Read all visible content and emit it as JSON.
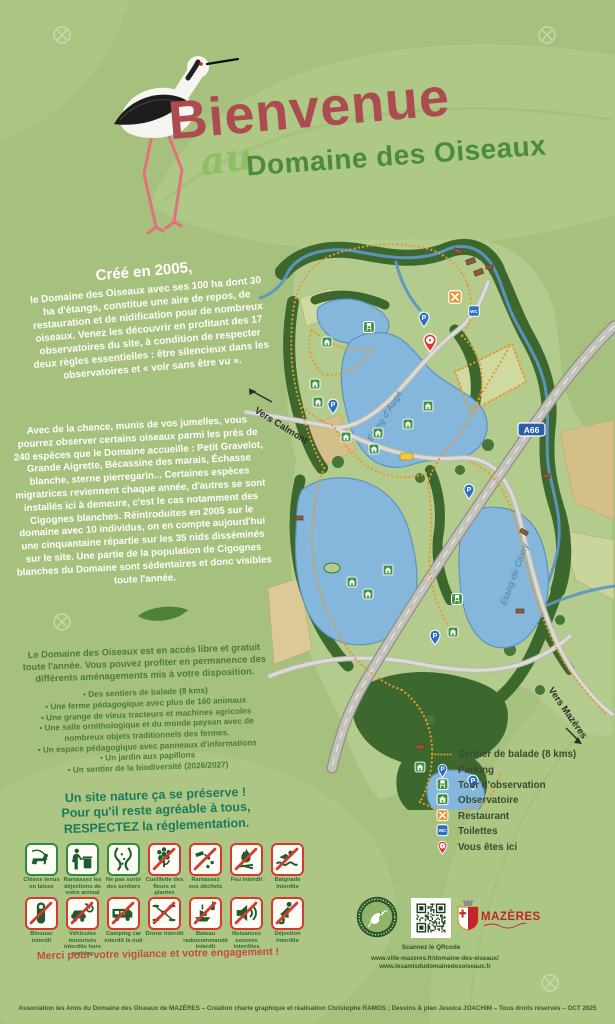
{
  "poster": {
    "title_main": "Bienvenue",
    "title_prefix": "au",
    "title_sub": "Domaine des Oiseaux"
  },
  "intro": {
    "heading": "Créé en 2005,",
    "body": "le Domaine des Oiseaux avec ses 100 ha dont 30 ha d'étangs, constitue une aire de repos, de restauration et de nidification pour de nombreux oiseaux. Venez les découvrir en profitant des 17 observatoires du site, à condition de respecter deux règles essentielles : être silencieux dans les observatoires et « voir sans être vu »."
  },
  "species_paragraph": "Avec de la chance, munis de vos jumelles, vous pourrez observer certains oiseaux parmi les près de 240 espèces que le Domaine accueille : Petit Gravelot, Grande Aigrette, Bécassine des marais, Échasse blanche, sterne pierregarin... Certaines espèces migratrices reviennent chaque année, d'autres se sont installés ici à demeure, c'est le cas notamment des Cigognes blanches. Réintroduites en 2005 sur le domaine avec 10 individus, on en compte aujourd'hui une cinquantaine répartie sur les 35 nids disséminés sur le site. Une partie de la population de Cigognes blanches du Domaine sont sédentaires et donc visibles toute l'année.",
  "access": {
    "intro": "Le Domaine des Oiseaux est en accès libre et gratuit toute l'année. Vous pouvez profiter en permanence des différents aménagements mis à votre disposition.",
    "items": [
      "Des sentiers de balade (8 kms)",
      "Une ferme pédagogique avec plus de 160 animaux",
      "Une grange de vieux tracteurs et machines agricoles",
      "Une salle ornithologique et du monde paysan avec de nombreux objets traditionnels des fermes.",
      "Un espace pédagogique avec panneaux d'informations",
      "Un jardin aux papillons",
      "Un sentier de la biodiversité (2026/2027)"
    ]
  },
  "rules": {
    "heading_line1": "Un site nature ça se préserve !",
    "heading_line2": "Pour qu'il reste agréable à tous,",
    "heading_line3": "RESPECTEZ la réglementation.",
    "row1": [
      {
        "icon": "dog-leash-icon",
        "type": "allowed",
        "label": "Chiens tenus en laisse"
      },
      {
        "icon": "pet-waste-icon",
        "type": "allowed",
        "label": "Ramassez les déjections de votre animal"
      },
      {
        "icon": "stay-on-path-icon",
        "type": "allowed",
        "label": "Ne pas sortir des sentiers"
      },
      {
        "icon": "flower-picking-icon",
        "type": "forbidden",
        "label": "Cueillette des fleurs et plantes interdite"
      },
      {
        "icon": "litter-icon",
        "type": "forbidden",
        "label": "Ramassez vos déchets"
      },
      {
        "icon": "fire-icon",
        "type": "forbidden",
        "label": "Feu interdit"
      },
      {
        "icon": "swimming-icon",
        "type": "forbidden",
        "label": "Baignade interdite"
      }
    ],
    "row2": [
      {
        "icon": "bivouac-icon",
        "type": "forbidden",
        "label": "Bivouac interdit"
      },
      {
        "icon": "motor-vehicle-icon",
        "type": "forbidden",
        "label": "Véhicules motorisés interdits hors parking"
      },
      {
        "icon": "camper-icon",
        "type": "forbidden",
        "label": "Camping car interdit la nuit"
      },
      {
        "icon": "drone-icon",
        "type": "forbidden",
        "label": "Drone interdit"
      },
      {
        "icon": "rc-boat-icon",
        "type": "forbidden",
        "label": "Bateau radiocommandé interdit"
      },
      {
        "icon": "noise-icon",
        "type": "forbidden",
        "label": "Nuisances sonores interdites"
      },
      {
        "icon": "defecation-icon",
        "type": "forbidden",
        "label": "Déjection interdite"
      }
    ],
    "thanks": "Merci pour votre vigilance et votre engagement !"
  },
  "map": {
    "labels": {
      "to_calmont": "Vers Calmont",
      "to_mazeres": "Vers Mazères",
      "highway": "A66",
      "lake_auge": "Étang d'Augé",
      "lake_cluny": "Étang de Cluny"
    },
    "legend": [
      {
        "icon": "trail-line-icon",
        "label": "Sentier de balade (8 kms)"
      },
      {
        "icon": "parking-pin-icon",
        "label": "Parking"
      },
      {
        "icon": "observation-tower-icon",
        "label": "Tour d'observation"
      },
      {
        "icon": "observatory-icon",
        "label": "Observatoire"
      },
      {
        "icon": "restaurant-icon",
        "label": "Restaurant"
      },
      {
        "icon": "toilets-icon",
        "label": "Toilettes"
      },
      {
        "icon": "you-are-here-icon",
        "label": "Vous êtes ici"
      }
    ]
  },
  "footer": {
    "qr_caption": "Scannez le QRcode",
    "site1": "www.ville-mazeres.fr/domaine-des-oiseaux/",
    "site2": "www.lesamisdudomainedesoiseaux.fr",
    "mazeres_logo": "MAZÈRES",
    "credits": "Association les Amis du Domaine des Oiseaux de MAZÈRES – Création charte graphique et réalisation Christophe RAMOS ; Dessins & plan Jessica JOACHIM – Tous droits réservés – OCT 2025"
  },
  "colors": {
    "background": "#a6c17d",
    "title_red": "#ac4b50",
    "title_green": "#4c8b3f",
    "title_light_green": "#8cc063",
    "teal_heading": "#1c7a5e",
    "trail_orange": "#e59a2f",
    "water_blue": "#85b7dc",
    "forbidden_red": "#d43a2f",
    "allowed_green": "#2e8b3f",
    "highway_badge_blue": "#2b5fa8"
  }
}
